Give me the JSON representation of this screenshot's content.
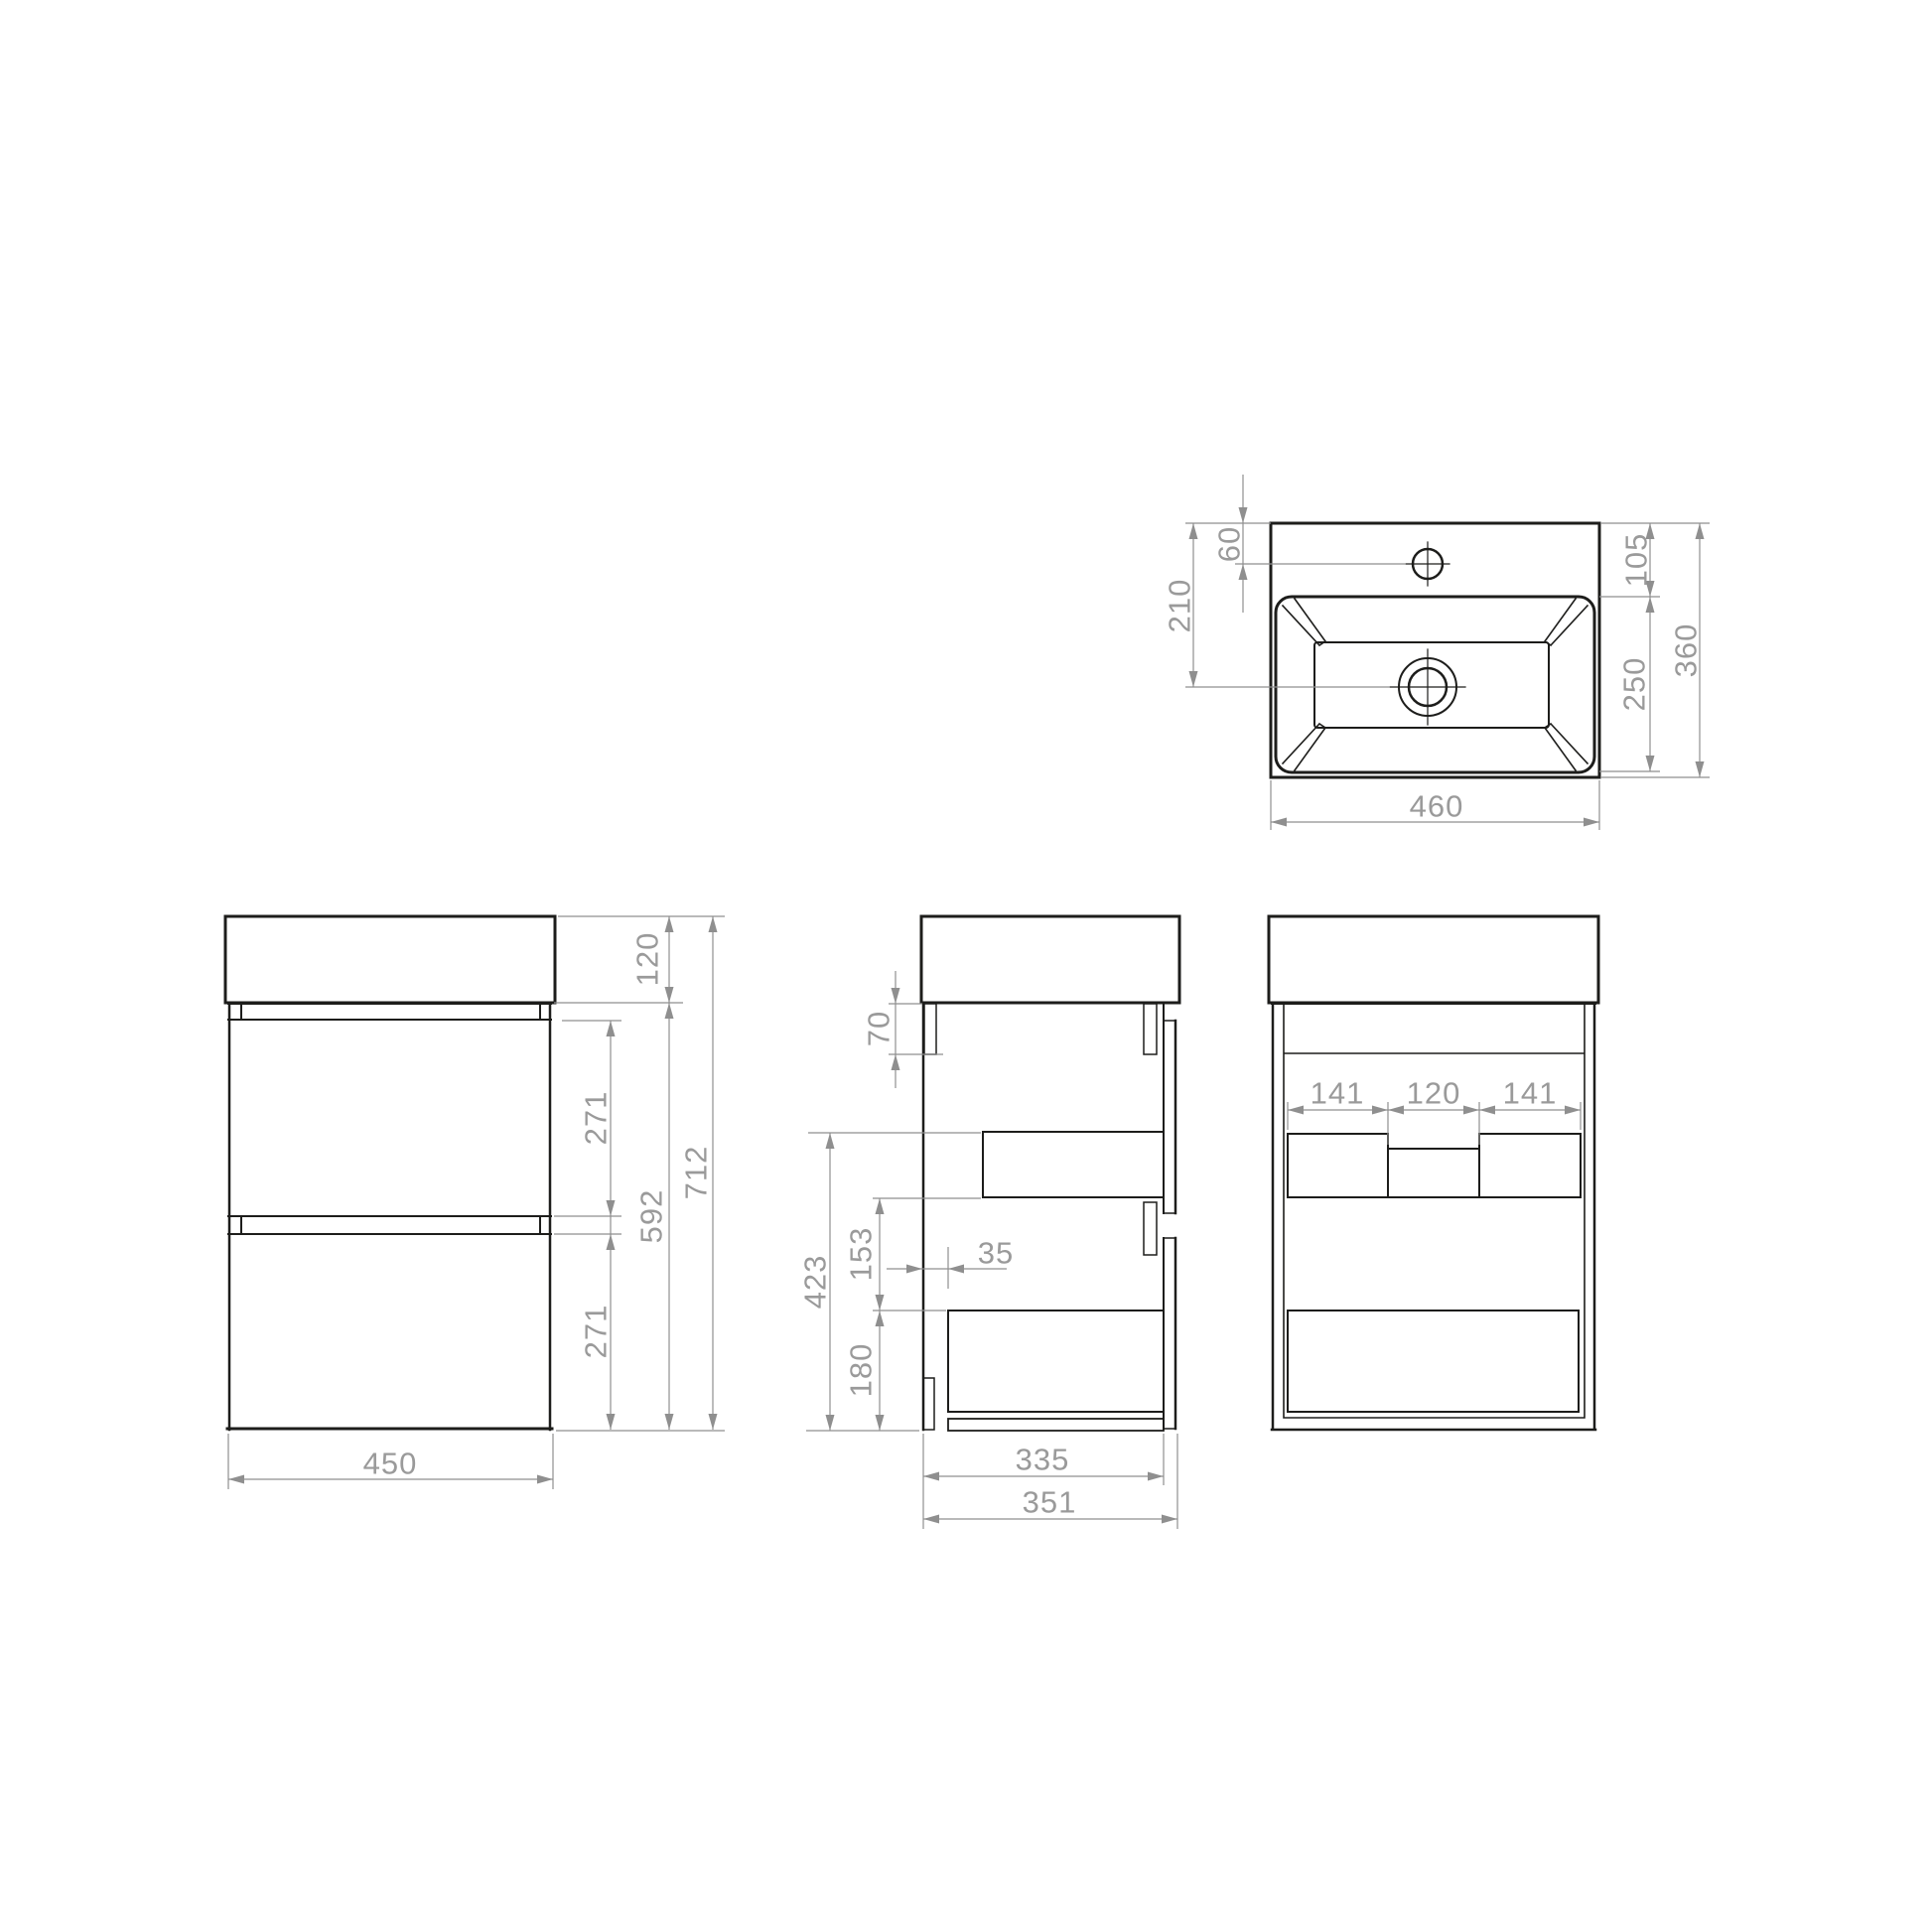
{
  "colors": {
    "object_line": "#1d1d1b",
    "dimension_line": "#8f8f8f",
    "dimension_text": "#9a9a9a",
    "background": "#ffffff"
  },
  "views": {
    "sink_top": {
      "dims": {
        "faucet_offset": "60",
        "drain_offset": "210",
        "rim_to_basin": "105",
        "basin_depth": "250",
        "total_depth": "360",
        "total_width": "460"
      }
    },
    "front": {
      "dims": {
        "basin_height": "120",
        "upper_drawer": "271",
        "carcass_height": "592",
        "lower_drawer": "271",
        "total_height": "712",
        "width": "450"
      }
    },
    "side": {
      "dims": {
        "mounting_rail": "70",
        "inner_height": "423",
        "drawer_spacing": "153",
        "lower_inner": "180",
        "back_inset": "35",
        "inner_depth": "335",
        "depth": "351"
      }
    },
    "back": {
      "dims": {
        "cutout_left": "141",
        "cutout_center": "120",
        "cutout_right": "141"
      }
    }
  }
}
